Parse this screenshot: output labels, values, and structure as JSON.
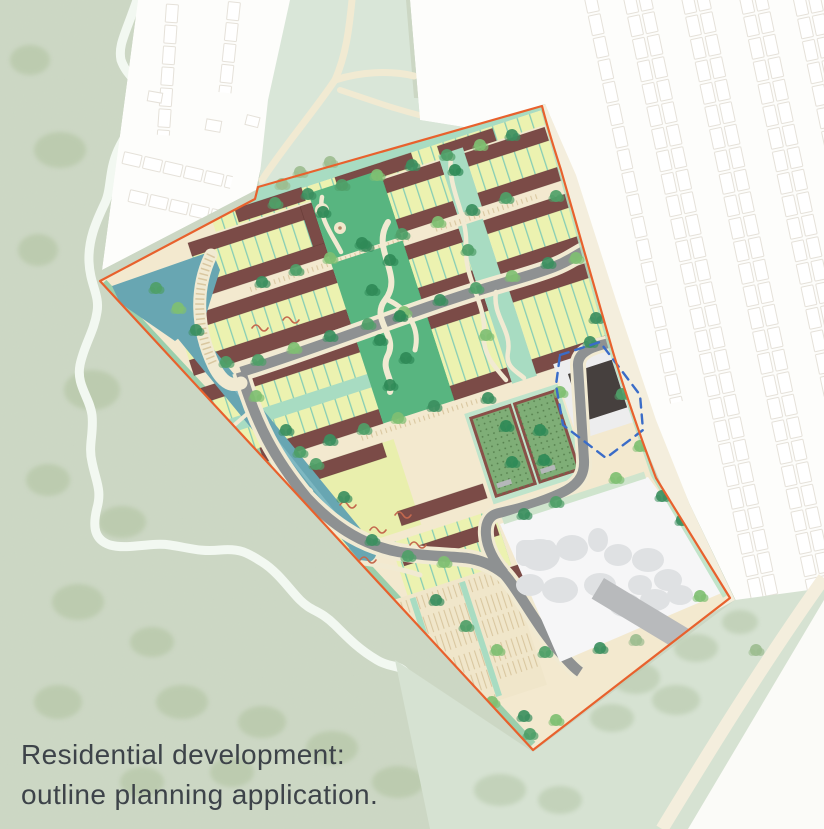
{
  "caption": {
    "line1": "Residential development:",
    "line2": "outline planning application."
  },
  "palette": {
    "bg": "#ccd7c4",
    "speck": "#9fb294",
    "stream": "#f2f8f1",
    "white": "#fdfdfb",
    "outline": "#e5e1d9",
    "wedge": "#d9e6d8",
    "cream": "#f1ead2",
    "siteBase": "#f3e9cf",
    "boundary": "#e8612d",
    "road": "#8e9192",
    "building": "#7b4b47",
    "yard": "#ecf2b0",
    "gridline": "#86cdb5",
    "mint": "#a8dcc2",
    "park": "#58b580",
    "water": "#68a6b2",
    "allot": "#7fae77",
    "allotBorder": "#8a4f48",
    "plotWhite": "#f6f6f7",
    "blob": "#dfe1e3",
    "grayBldg": "#b8babc",
    "darkBldg": "#46403e",
    "blueDash": "#3a6cc8",
    "bottomGreen": "#d6e2d2",
    "buffer": "#f4eedd",
    "tick": "#d9c7a0",
    "hedge": "#c4684e",
    "ink": "#3d4349"
  },
  "map": {
    "site": "residential development site",
    "water_feature": "drainage channel and basin",
    "green_spine": "central linear park",
    "south_plot": "retained industrial plot",
    "reserved_plot": "reserved plot (dashed outline)",
    "surroundings": "existing housing and parkland"
  }
}
